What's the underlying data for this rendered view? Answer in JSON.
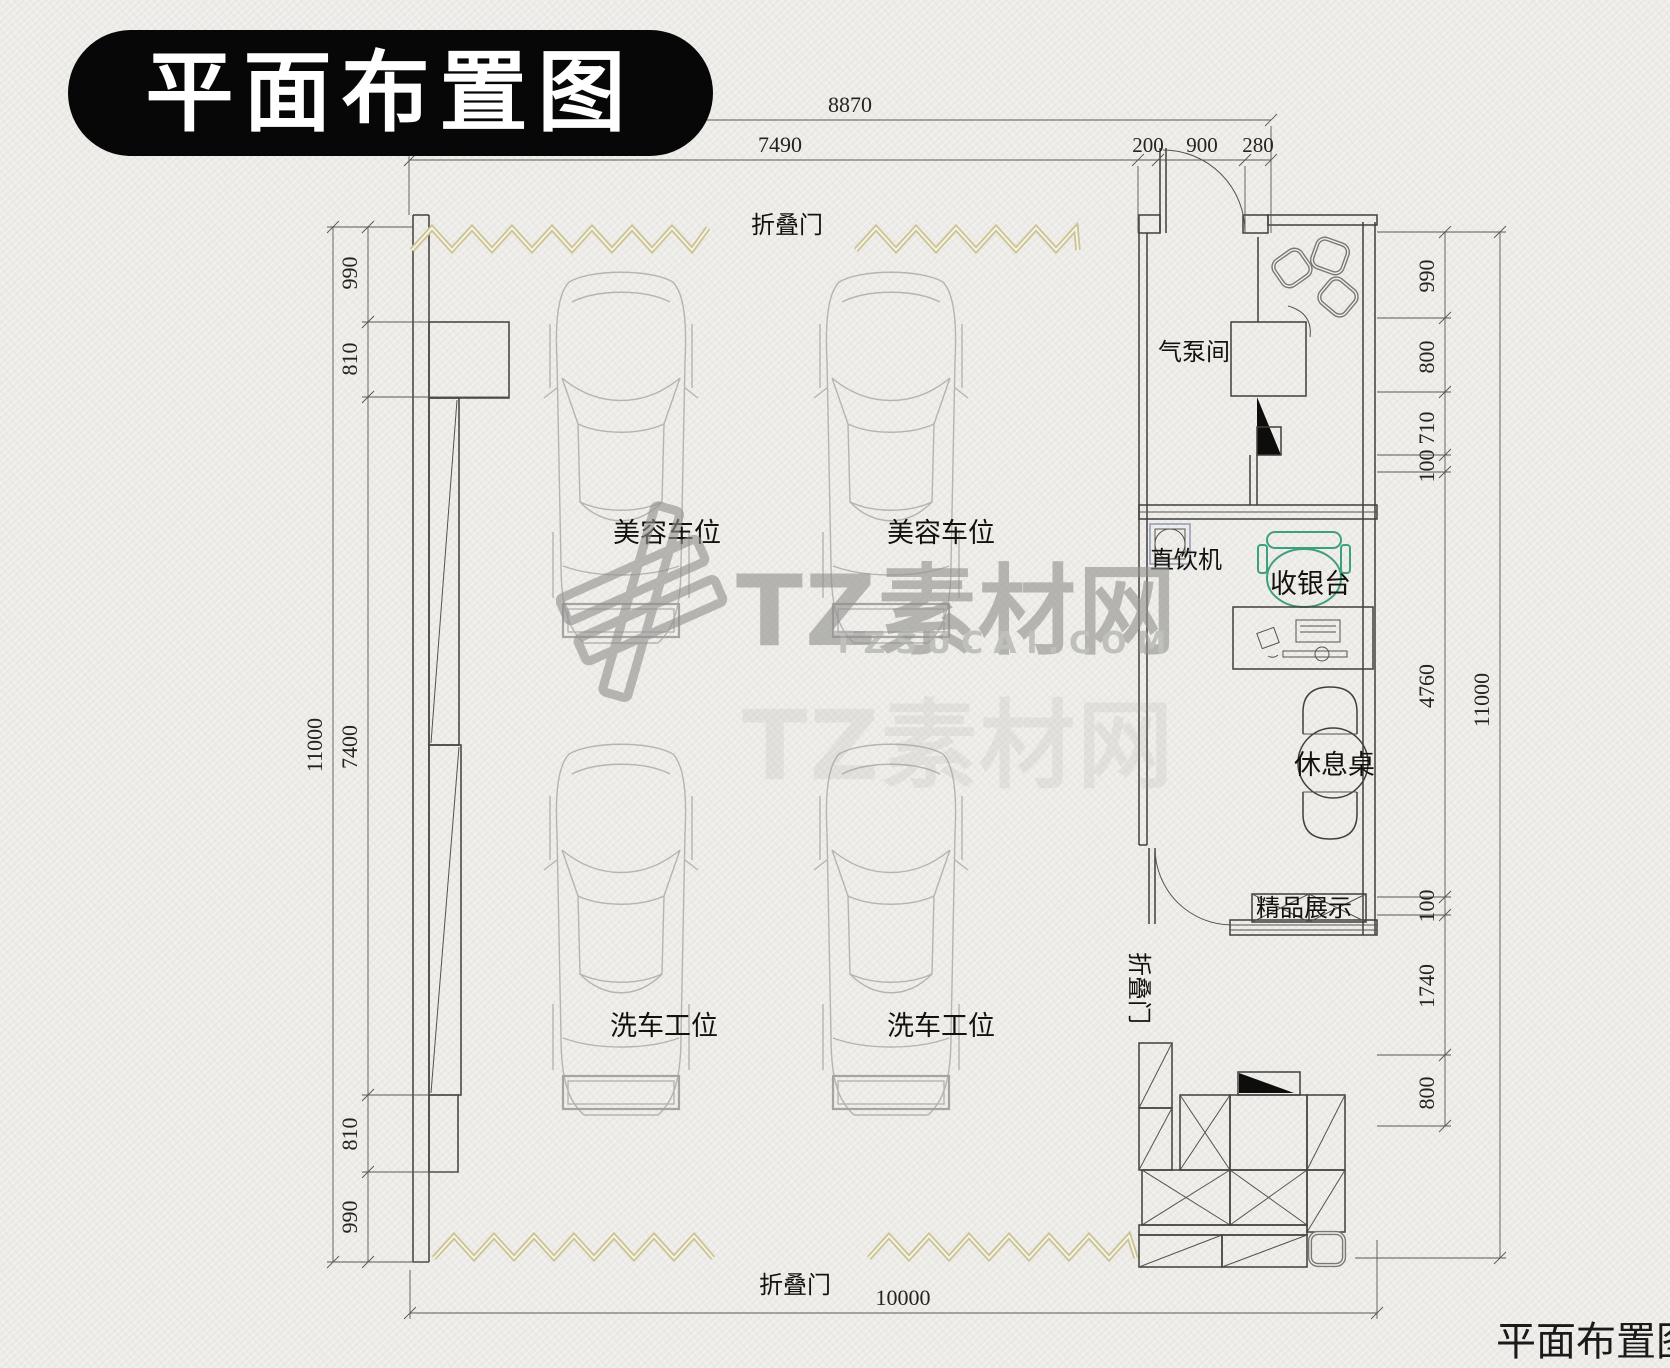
{
  "title": {
    "badge": "平面布置图",
    "corner": "平面布置图"
  },
  "watermark": {
    "brand": "TZ素材网",
    "domain": "TZSUCAI.COM"
  },
  "labels": {
    "folding_door_top": "折叠门",
    "folding_door_bottom": "折叠门",
    "folding_door_side": "折叠门",
    "pump_room": "气泵间",
    "water_dispenser": "直饮机",
    "cashier_desk": "收银台",
    "rest_table": "休息桌",
    "boutique_display": "精品展示",
    "beauty_bay_1": "美容车位",
    "beauty_bay_2": "美容车位",
    "wash_bay_1": "洗车工位",
    "wash_bay_2": "洗车工位"
  },
  "dimensions": {
    "top": {
      "overall": "8870",
      "inner": "7490",
      "seg_200": "200",
      "seg_900": "900",
      "seg_280": "280"
    },
    "bottom": {
      "overall": "10000"
    },
    "left": {
      "overall": "11000",
      "segments": [
        "990",
        "810",
        "7400",
        "810",
        "990"
      ]
    },
    "right": {
      "overall": "11000",
      "segments": [
        "990",
        "800",
        "710",
        "100",
        "4760",
        "100",
        "1740",
        "800"
      ]
    }
  },
  "colors": {
    "folding_door": "#ccc493",
    "cashier_accent": "#3da07c",
    "ink": "#413f3b",
    "car_line": "#b6b4b0",
    "watermark_gray": "#929290"
  }
}
